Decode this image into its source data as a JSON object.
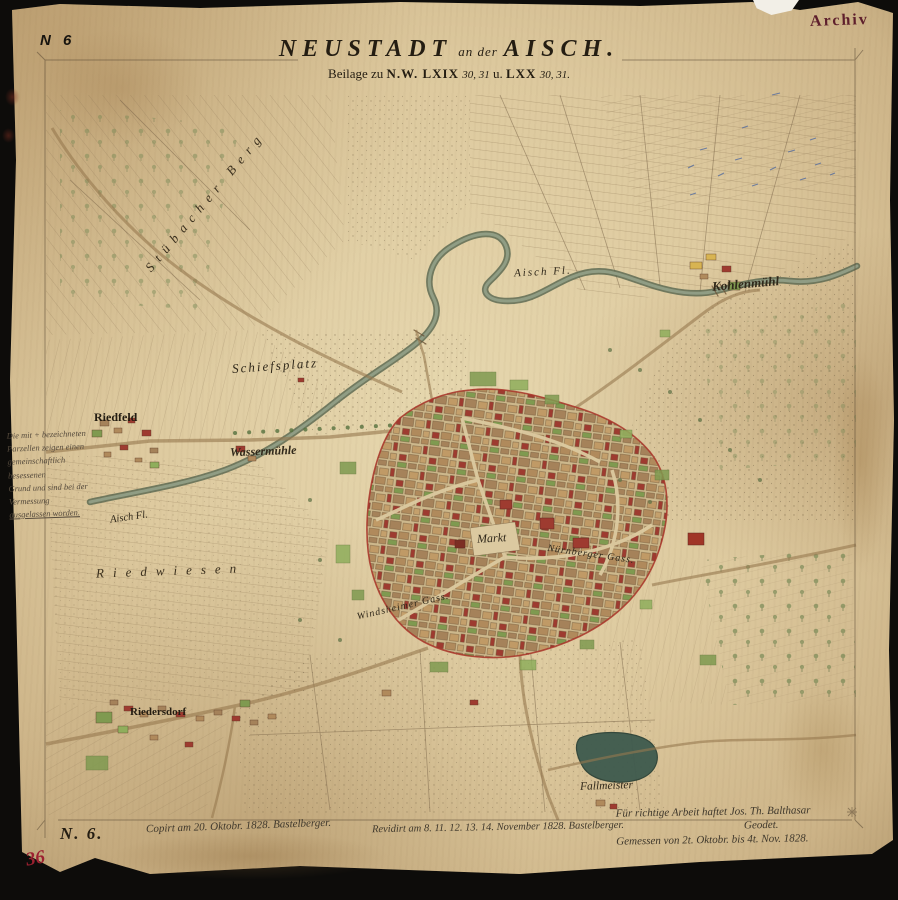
{
  "header": {
    "sheet_number": "N 6",
    "stamp": "Archiv",
    "title_main": "NEUSTADT",
    "title_connector": "an der",
    "title_place": "AISCH.",
    "subtitle_parts": {
      "pre": "Beilage zu",
      "ref1": "N.W. LXIX",
      "no1": "30, 31",
      "conn": "u.",
      "ref2": "LXX",
      "no2": "30, 31."
    }
  },
  "map": {
    "labels": {
      "stuebacher_berg": "Stübacher Berg",
      "schiessplatz": "Schiefsplatz",
      "riedfeld": "Riedfeld",
      "wassermuehle": "Wassermühle",
      "aisch_fl_1": "Aisch Fl.",
      "aisch_fl_2": "Aisch Fl.",
      "riedwiesen": "Riedwiesen",
      "kohlenmuehl": "Kohlenmühl",
      "markt": "Markt",
      "nuernberger_gass": "Nürnberger Gass.",
      "windsheimer_gass": "Windsheimer Gass.",
      "riedersdorf": "Riedersdorf",
      "fallmeister": "Fallmeister"
    }
  },
  "margin_note": {
    "lines": [
      "Die mit + bezeichneten",
      "Parzellen zeigen einen",
      "gemeinschaftlich besessenen",
      "Grund und sind bei der",
      "Vermessung",
      "ausgelassen worden."
    ]
  },
  "footer": {
    "sheet_number": "N. 6.",
    "note_left": "Copirt am 20. Oktobr. 1828. Bastelberger.",
    "note_center": "Revidirt am 8. 11. 12. 13. 14. November 1828. Bastelberger.",
    "note_right_1": "Für richtige Arbeit haftet Jos. Th. Balthasar",
    "note_right_2": "Geodet.",
    "note_right_3": "Gemessen von 2t. Oktobr. bis 4t. Nov. 1828.",
    "corner_number": "36"
  },
  "colors": {
    "paper": "#ddc99e",
    "ink": "#30281a",
    "stamp_red": "#5e1f2c",
    "town_boundary_red": "#a83228",
    "building_red": "#9e3b30",
    "meadow_green": "#7f9a50",
    "water": "#55644d",
    "survey_blue": "#4a66a0"
  }
}
